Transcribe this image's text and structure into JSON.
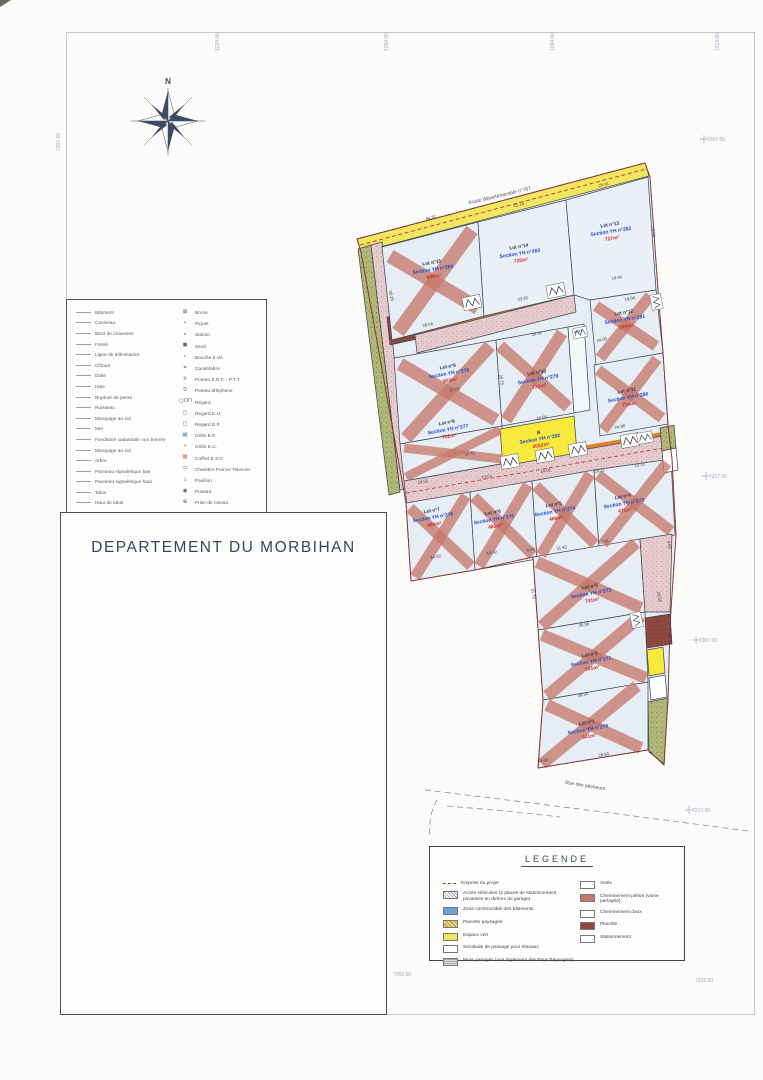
{
  "colors": {
    "paper": "#fbfbf9",
    "lot_fill": "#e7edf4",
    "road_yellow": "#f0e65f",
    "road_pink": "#e6cbce",
    "green_strip": "#b2b978",
    "placette_dark": "#8e4a41",
    "hatch_salmon": "#c5796a",
    "label_blue": "#1f49c7",
    "label_red": "#cc2e2e",
    "boundary_red": "#c03333",
    "parcel_b_yellow": "#f7ea3c"
  },
  "compass": {
    "north_label": "N"
  },
  "title_block": {
    "department": "DEPARTEMENT DU MORBIHAN"
  },
  "legend_box": {
    "title": "LEGENDE",
    "left_items": [
      {
        "swatch": "dash-red",
        "label": "Emprise du projet"
      },
      {
        "swatch": "hatch-gray",
        "label": "Accès véhicules (2 places de stationnement privatives en dehors du garage)"
      },
      {
        "swatch": "blue",
        "label": "Zone constructible des bâtiments"
      },
      {
        "swatch": "speckle-brown",
        "label": "Placette paysagée"
      },
      {
        "swatch": "yellow",
        "label": "Espace vert"
      },
      {
        "swatch": "white",
        "label": "Servitude de passage pour réseaux"
      },
      {
        "swatch": "speckle-gray",
        "label": "Murs partagés (voir règlement des Pays Paysagers)"
      }
    ],
    "right_items": [
      {
        "swatch": "white",
        "label": "Voirie"
      },
      {
        "swatch": "salmon",
        "label": "Cheminement piéton (voirie partagée)"
      },
      {
        "swatch": "white",
        "label": "Cheminement doux"
      },
      {
        "swatch": "darkred",
        "label": "Placette"
      },
      {
        "swatch": "white",
        "label": "Stationnement"
      }
    ]
  },
  "survey_legend": {
    "left_items": [
      "Bâtiment",
      "Caniveau",
      "Bord de chaussée",
      "Fossé",
      "Ligne de délimitation",
      "Clôture",
      "Dalle",
      "Haie",
      "Rupture de pente",
      "Ruisseau",
      "Marquage au sol",
      "Mur",
      "Fondation cadastrale non bornée",
      "Marquage au sol",
      "Arbre",
      "Panneau signalétique bas",
      "Panneau signalétique haut",
      "Talus",
      "Haut de talus"
    ],
    "right_items": [
      {
        "glyph": "⊠",
        "label": "Borne"
      },
      {
        "glyph": "•",
        "label": "Piquet"
      },
      {
        "glyph": "▵",
        "label": "Station"
      },
      {
        "glyph": "◼",
        "label": "Seuil"
      },
      {
        "glyph": "∘",
        "label": "Bouche à clé"
      },
      {
        "glyph": "✶",
        "label": "Candélabre"
      },
      {
        "glyph": "⌾",
        "label": "Poteau E.D.F. - P.T.T."
      },
      {
        "glyph": "⍉",
        "label": "Poteau téléphone"
      },
      {
        "glyph": "◻O⊓",
        "label": "Regard"
      },
      {
        "glyph": "◻",
        "label": "Regard E.U."
      },
      {
        "glyph": "◻",
        "label": "Regard E.P."
      },
      {
        "glyph": "▦",
        "label": "Grille E.P.",
        "color": "#4d8bd6"
      },
      {
        "glyph": "÷",
        "label": "Grille E.U."
      },
      {
        "glyph": "▩",
        "label": "Coffret E.D.F.",
        "color": "#e0705a"
      },
      {
        "glyph": "▭",
        "label": "Chambre France Telecom"
      },
      {
        "glyph": "⌂",
        "label": "Pavillon"
      },
      {
        "glyph": "◉",
        "label": "Puisard"
      },
      {
        "glyph": "⊕",
        "label": "Prise de niveau"
      }
    ]
  },
  "map": {
    "road_top_label": "Route départementale n°767",
    "road_bottom_label": "Rue des pêcheurs",
    "lots": [
      {
        "id": "lot-15",
        "lot": "Lot n°15",
        "section": "Section YH n°284",
        "area": "696m²",
        "hatched": true
      },
      {
        "id": "lot-14",
        "lot": "Lot n°14",
        "section": "Section YH n°283",
        "area": "725m²",
        "hatched": false
      },
      {
        "id": "lot-13",
        "lot": "Lot n°13",
        "section": "Section YH n°282",
        "area": "727m²",
        "hatched": false
      },
      {
        "id": "lot-12",
        "lot": "Lot n°12",
        "section": "Section YH n°281",
        "area": "704m²",
        "hatched": true
      },
      {
        "id": "lot-9",
        "lot": "Lot n°9",
        "section": "Section YH n°278",
        "area": "802m²",
        "hatched": true
      },
      {
        "id": "lot-10",
        "lot": "Lot n°10",
        "section": "Section YH n°279",
        "area": "722m²",
        "hatched": true
      },
      {
        "id": "lot-11",
        "lot": "Lot n°11",
        "section": "Section YH n°280",
        "area": "734m²",
        "hatched": true
      },
      {
        "id": "lot-8",
        "lot": "Lot n°8",
        "section": "Section YH n°277",
        "area": "702m²",
        "hatched": true
      },
      {
        "id": "parcel-b",
        "lot": "B",
        "section": "Section YH n°292",
        "area": "2052m²",
        "hatched": false
      },
      {
        "id": "lot-7",
        "lot": "Lot n°7",
        "section": "Section YH n°276",
        "area": "486m²",
        "hatched": true
      },
      {
        "id": "lot-6",
        "lot": "Lot n°6",
        "section": "Section YH n°275",
        "area": "480m²",
        "hatched": true
      },
      {
        "id": "lot-5",
        "lot": "Lot n°5",
        "section": "Section YH n°274",
        "area": "469m²",
        "hatched": true
      },
      {
        "id": "lot-4",
        "lot": "Lot n°4",
        "section": "Section YH n°273",
        "area": "471m²",
        "hatched": true
      },
      {
        "id": "lot-3",
        "lot": "Lot n°3",
        "section": "Section YH n°272",
        "area": "741m²",
        "hatched": true
      },
      {
        "id": "lot-2",
        "lot": "Lot n°2",
        "section": "Section YH n°271",
        "area": "541m²",
        "hatched": true
      },
      {
        "id": "lot-1",
        "lot": "Lot n°1",
        "section": "Section YH n°270",
        "area": "541m²",
        "hatched": true
      }
    ],
    "dimensions": [
      {
        "t": "46.32",
        "x": 431,
        "y": 219,
        "r": -14
      },
      {
        "t": "23.14",
        "x": 519,
        "y": 206,
        "r": -13
      },
      {
        "t": "25.01",
        "x": 604,
        "y": 186,
        "r": -13
      },
      {
        "t": "28.04",
        "x": 428,
        "y": 326,
        "r": -11
      },
      {
        "t": "23.50",
        "x": 523,
        "y": 300,
        "r": -11
      },
      {
        "t": "19.84",
        "x": 617,
        "y": 279,
        "r": -9
      },
      {
        "t": "16.04",
        "x": 652,
        "y": 232,
        "r": 82
      },
      {
        "t": "30.29",
        "x": 390,
        "y": 296,
        "r": 78
      },
      {
        "t": "20.09",
        "x": 537,
        "y": 335,
        "r": -11
      },
      {
        "t": "4.00",
        "x": 578,
        "y": 333,
        "r": -11
      },
      {
        "t": "24.00",
        "x": 602,
        "y": 341,
        "r": -11
      },
      {
        "t": "19.04",
        "x": 630,
        "y": 300,
        "r": -9
      },
      {
        "t": "27.09",
        "x": 455,
        "y": 391,
        "r": -11
      },
      {
        "t": "20.75",
        "x": 500,
        "y": 380,
        "r": 80
      },
      {
        "t": "20.56",
        "x": 542,
        "y": 419,
        "r": -11
      },
      {
        "t": "24.98",
        "x": 620,
        "y": 428,
        "r": -9
      },
      {
        "t": "20.41",
        "x": 470,
        "y": 455,
        "r": -11
      },
      {
        "t": "18.21",
        "x": 600,
        "y": 472,
        "r": -9
      },
      {
        "t": "10.21",
        "x": 640,
        "y": 466,
        "r": -9
      },
      {
        "t": "15.53",
        "x": 423,
        "y": 483,
        "r": -11
      },
      {
        "t": "13.02",
        "x": 487,
        "y": 478,
        "r": -11
      },
      {
        "t": "14.02",
        "x": 546,
        "y": 472,
        "r": -11
      },
      {
        "t": "14.82",
        "x": 436,
        "y": 558,
        "r": -11
      },
      {
        "t": "14.62",
        "x": 492,
        "y": 554,
        "r": -11
      },
      {
        "t": "9.59",
        "x": 531,
        "y": 551,
        "r": -11
      },
      {
        "t": "11.42",
        "x": 562,
        "y": 549,
        "r": -11
      },
      {
        "t": "17.81",
        "x": 604,
        "y": 543,
        "r": -11
      },
      {
        "t": "4.66",
        "x": 668,
        "y": 545,
        "r": 80
      },
      {
        "t": "31.70",
        "x": 532,
        "y": 594,
        "r": 80
      },
      {
        "t": "23.58",
        "x": 658,
        "y": 597,
        "r": 80
      },
      {
        "t": "30.38",
        "x": 584,
        "y": 626,
        "r": -10
      },
      {
        "t": "38.34",
        "x": 583,
        "y": 696,
        "r": -10
      },
      {
        "t": "59.99",
        "x": 543,
        "y": 762,
        "r": -10
      },
      {
        "t": "28.60",
        "x": 604,
        "y": 756,
        "r": -10
      }
    ],
    "grid_labels": [
      {
        "t": "1224.00",
        "x": 219,
        "y": 42,
        "v": true
      },
      {
        "t": "1254.00",
        "x": 388,
        "y": 42,
        "v": true
      },
      {
        "t": "1284.00",
        "x": 554,
        "y": 42,
        "v": true
      },
      {
        "t": "1314.00",
        "x": 719,
        "y": 42,
        "v": true
      },
      {
        "t": "7207.00",
        "x": 60,
        "y": 142,
        "v": true
      },
      {
        "t": "7207.00",
        "x": 716,
        "y": 141,
        "cross": true
      },
      {
        "t": "7217.00",
        "x": 718,
        "y": 478,
        "cross": true
      },
      {
        "t": "7207.00",
        "x": 708,
        "y": 642,
        "cross": true
      },
      {
        "t": "7217.00",
        "x": 701,
        "y": 812,
        "cross": true
      },
      {
        "t": "7263.00",
        "x": 402,
        "y": 976
      },
      {
        "t": "7203.00",
        "x": 704,
        "y": 982
      }
    ]
  }
}
